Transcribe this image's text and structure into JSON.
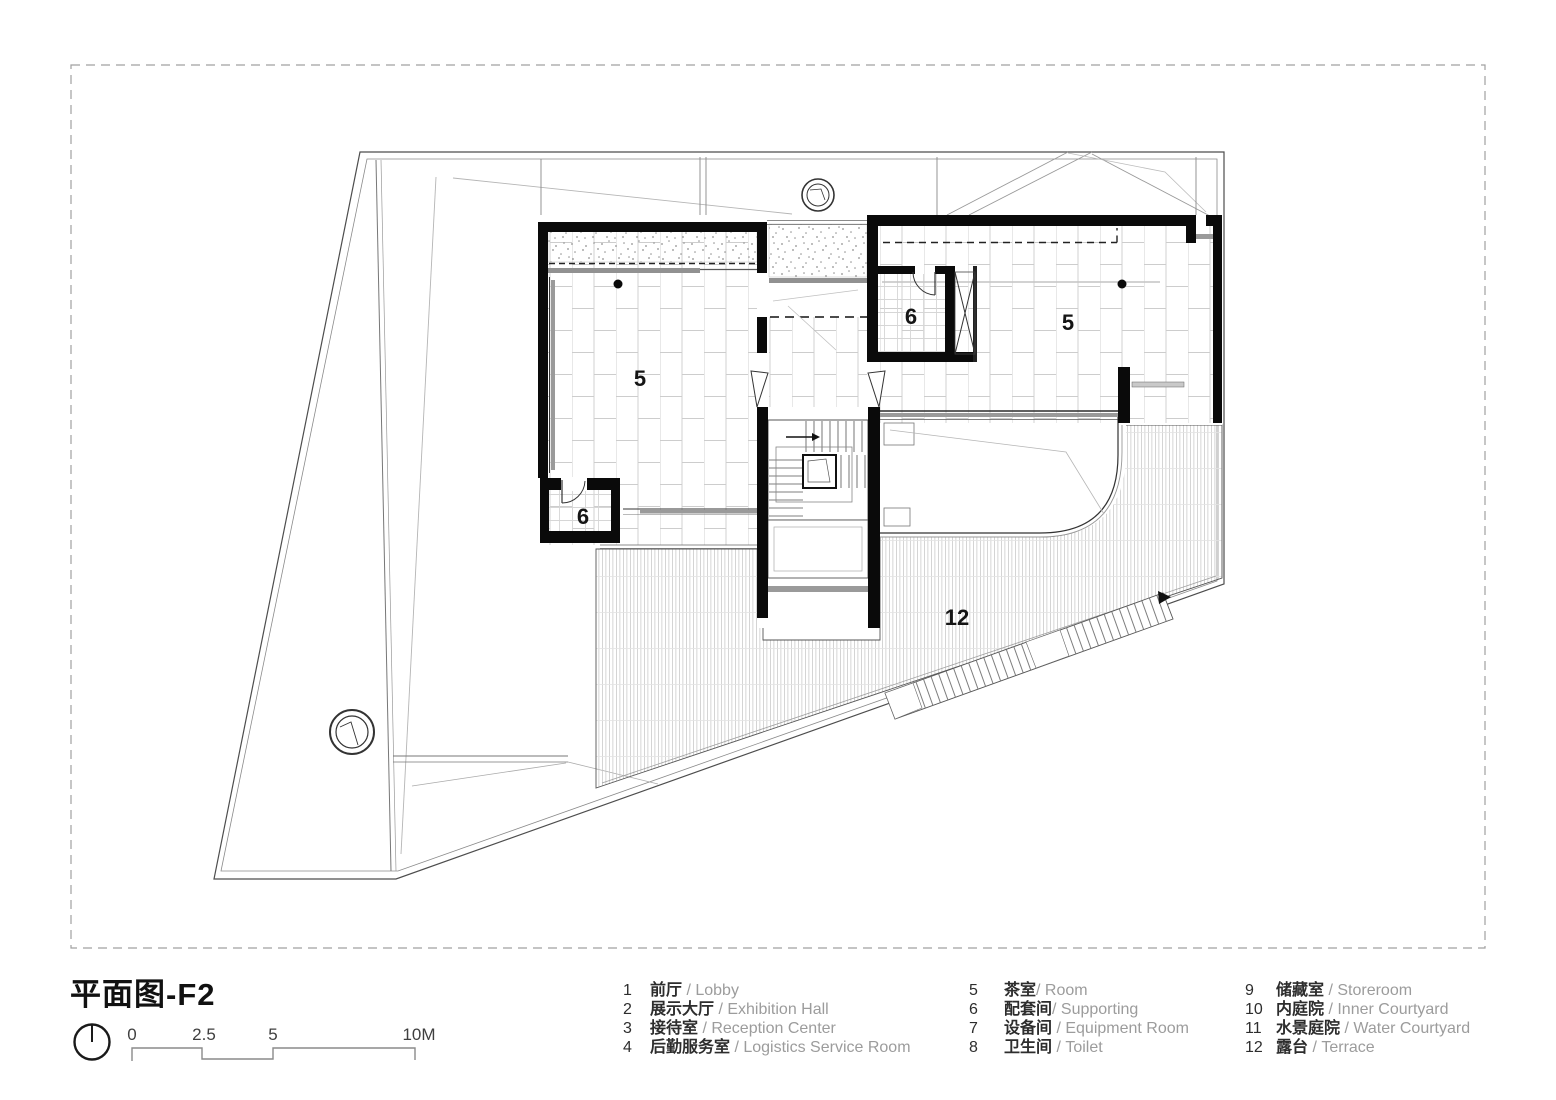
{
  "title": "平面图-F2",
  "north_icon": "north-indicator",
  "scale_bar": {
    "labels": [
      "0",
      "2.5",
      "5",
      "10M"
    ]
  },
  "rooms": {
    "room5_left": "5",
    "room6_left": "6",
    "room6_center": "6",
    "room5_right": "5",
    "terrace": "12"
  },
  "legend": {
    "items": [
      {
        "num": "1",
        "zh": "前厅",
        "en": " / Lobby"
      },
      {
        "num": "2",
        "zh": "展示大厅",
        "en": " / Exhibition Hall"
      },
      {
        "num": "3",
        "zh": "接待室",
        "en": " / Reception Center"
      },
      {
        "num": "4",
        "zh": "后勤服务室",
        "en": " / Logistics Service Room"
      },
      {
        "num": "5",
        "zh": "茶室",
        "en": "/ Room"
      },
      {
        "num": "6",
        "zh": "配套间",
        "en": "/ Supporting"
      },
      {
        "num": "7",
        "zh": "设备间",
        "en": " / Equipment Room"
      },
      {
        "num": "8",
        "zh": "卫生间",
        "en": " / Toilet"
      },
      {
        "num": "9",
        "zh": "储藏室",
        "en": " / Storeroom"
      },
      {
        "num": "10",
        "zh": "内庭院",
        "en": " / Inner Courtyard"
      },
      {
        "num": "11",
        "zh": "水景庭院",
        "en": " / Water Courtyard"
      },
      {
        "num": "12",
        "zh": "露台",
        "en": " / Terrace"
      }
    ]
  },
  "colors": {
    "wall": "#0a0a0a",
    "line": "#555555",
    "muted": "#9c9c9c"
  }
}
